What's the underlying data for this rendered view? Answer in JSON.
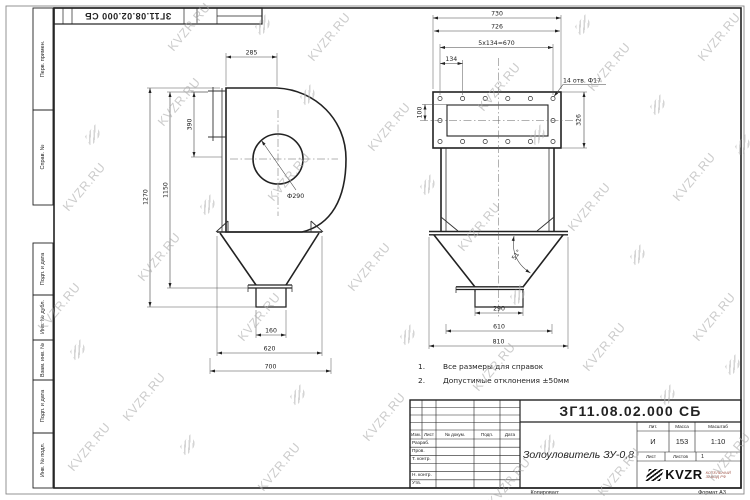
{
  "watermark": {
    "text": "KVZR.RU"
  },
  "corner_stamp": {
    "designation": "ЗГ11.08.02.000 СБ"
  },
  "side_labels": {
    "perv": "Перв. примен.",
    "sprav": "Справ. №",
    "podp1": "Подп. и дата",
    "inv_dubl": "Инв. № дубл.",
    "vzam": "Взам. инв. №",
    "podp2": "Подп. и дата",
    "inv_podl": "Инв. № подл."
  },
  "notes": {
    "n1": "1.",
    "t1": "Все размеры для справок",
    "n2": "2.",
    "t2": "Допустимые отклонения ±50мм"
  },
  "views": {
    "left": {
      "dims": {
        "top": "285",
        "flange": "390",
        "h1": "1150",
        "h2": "1270",
        "circle": "Ф290",
        "outlet": "160",
        "w1": "620",
        "w2": "700"
      }
    },
    "right": {
      "dims": {
        "w_top1": "730",
        "w_top2": "726",
        "holes_span": "5x134=670",
        "pitch": "134",
        "holes_note": "14 отв. Ф17",
        "inlet_h": "100",
        "flange_h": "326",
        "angle": "51°",
        "outlet": "290",
        "w_mid": "610",
        "w_bot": "810"
      }
    }
  },
  "title_block": {
    "designation": "ЗГ11.08.02.000 СБ",
    "name": "Золоуловитель ЗУ-0,8",
    "header_cols": [
      "Изм.",
      "Лист",
      "№ докум.",
      "Подп.",
      "Дата"
    ],
    "rows": [
      "Разраб.",
      "Пров.",
      "Т. контр.",
      "",
      "Н. контр.",
      "Утв."
    ],
    "lit_label": "Лит.",
    "lit": "И",
    "mass_label": "Масса",
    "mass": "153",
    "scale_label": "Масштаб",
    "scale": "1:10",
    "sheet_label": "Лист",
    "sheets_label": "Листов",
    "sheets": "1",
    "brand": "KVZR",
    "brand_sub1": "КОТЕЛЬНЫЙ",
    "brand_sub2": "ЗАВОД РФ",
    "copied": "Копировал:",
    "format": "Формат А3"
  }
}
